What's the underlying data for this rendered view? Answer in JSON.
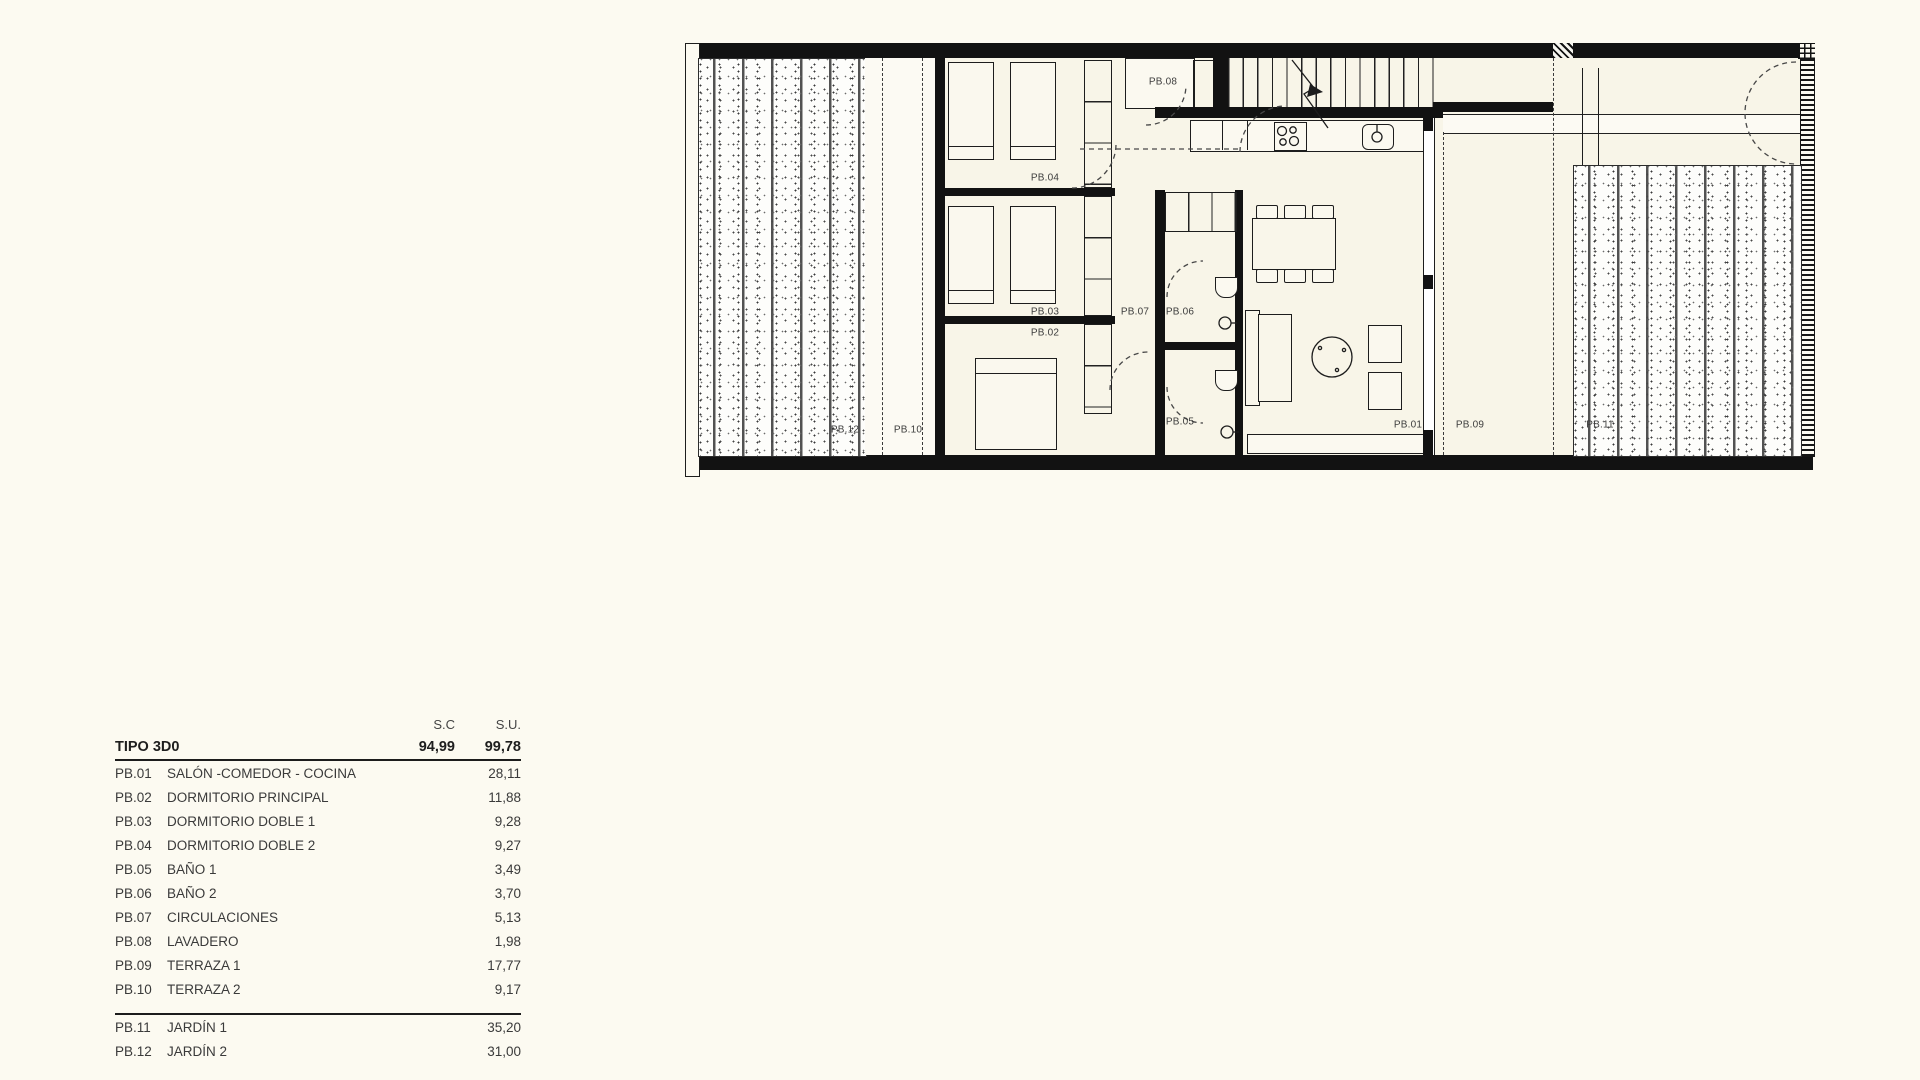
{
  "colors": {
    "ink": "#1a1a1a",
    "paper": "#fcfaf1"
  },
  "plan": {
    "room_labels": [
      {
        "id": "pb01",
        "text": "PB.01"
      },
      {
        "id": "pb02",
        "text": "PB.02"
      },
      {
        "id": "pb03",
        "text": "PB.03"
      },
      {
        "id": "pb04",
        "text": "PB.04"
      },
      {
        "id": "pb05",
        "text": "PB.05"
      },
      {
        "id": "pb06",
        "text": "PB.06"
      },
      {
        "id": "pb07",
        "text": "PB.07"
      },
      {
        "id": "pb08",
        "text": "PB.08"
      },
      {
        "id": "pb09",
        "text": "PB.09"
      },
      {
        "id": "pb10",
        "text": "PB.10"
      },
      {
        "id": "pb11",
        "text": "PB.11"
      },
      {
        "id": "pb12",
        "text": "PB.12"
      }
    ]
  },
  "table": {
    "col_headers": {
      "sc": "S.C",
      "su": "S.U."
    },
    "total_row": {
      "name": "TIPO 3D0",
      "sc": "94,99",
      "su": "99,78"
    },
    "rows": [
      {
        "code": "PB.01",
        "name": "SALÓN -COMEDOR - COCINA",
        "su": "28,11"
      },
      {
        "code": "PB.02",
        "name": "DORMITORIO PRINCIPAL",
        "su": "11,88"
      },
      {
        "code": "PB.03",
        "name": "DORMITORIO DOBLE 1",
        "su": "9,28"
      },
      {
        "code": "PB.04",
        "name": "DORMITORIO DOBLE 2",
        "su": "9,27"
      },
      {
        "code": "PB.05",
        "name": "BAÑO 1",
        "su": "3,49"
      },
      {
        "code": "PB.06",
        "name": "BAÑO 2",
        "su": "3,70"
      },
      {
        "code": "PB.07",
        "name": "CIRCULACIONES",
        "su": "5,13"
      },
      {
        "code": "PB.08",
        "name": "LAVADERO",
        "su": "1,98"
      },
      {
        "code": "PB.09",
        "name": "TERRAZA 1",
        "su": "17,77"
      },
      {
        "code": "PB.10",
        "name": "TERRAZA 2",
        "su": "9,17"
      }
    ],
    "garden_rows": [
      {
        "code": "PB.11",
        "name": "JARDÍN 1",
        "su": "35,20"
      },
      {
        "code": "PB.12",
        "name": "JARDÍN 2",
        "su": "31,00"
      }
    ]
  }
}
